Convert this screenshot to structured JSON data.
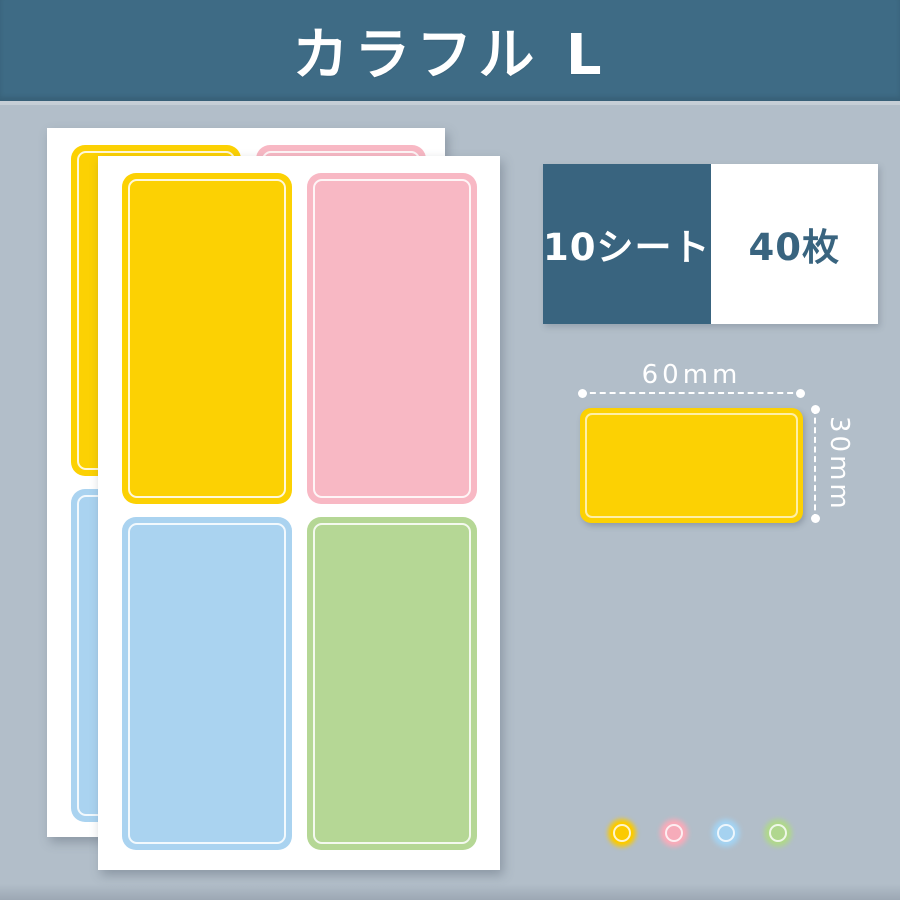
{
  "page": {
    "background": "#b2bec9"
  },
  "header": {
    "title": "カラフル L",
    "background": "#3e6b85",
    "text_color": "#ffffff"
  },
  "badge": {
    "sheet_count": "10シート",
    "piece_count": "40枚",
    "dark_bg": "#39647f",
    "dark_text": "#ffffff",
    "light_bg": "#ffffff",
    "light_text": "#39647f"
  },
  "size_sample": {
    "width_label": "60mm",
    "height_label": "30mm",
    "fill": "#fcd103",
    "marker_color": "#ffffff"
  },
  "colors": {
    "yellow": "#fcd103",
    "pink": "#f8b8c4",
    "blue": "#aad3f0",
    "green": "#b5d795"
  },
  "color_dots": [
    {
      "name": "yellow",
      "hex": "#fbca00"
    },
    {
      "name": "pink",
      "hex": "#f6acba"
    },
    {
      "name": "blue",
      "hex": "#a5d2f0"
    },
    {
      "name": "green",
      "hex": "#b0d78e"
    }
  ]
}
